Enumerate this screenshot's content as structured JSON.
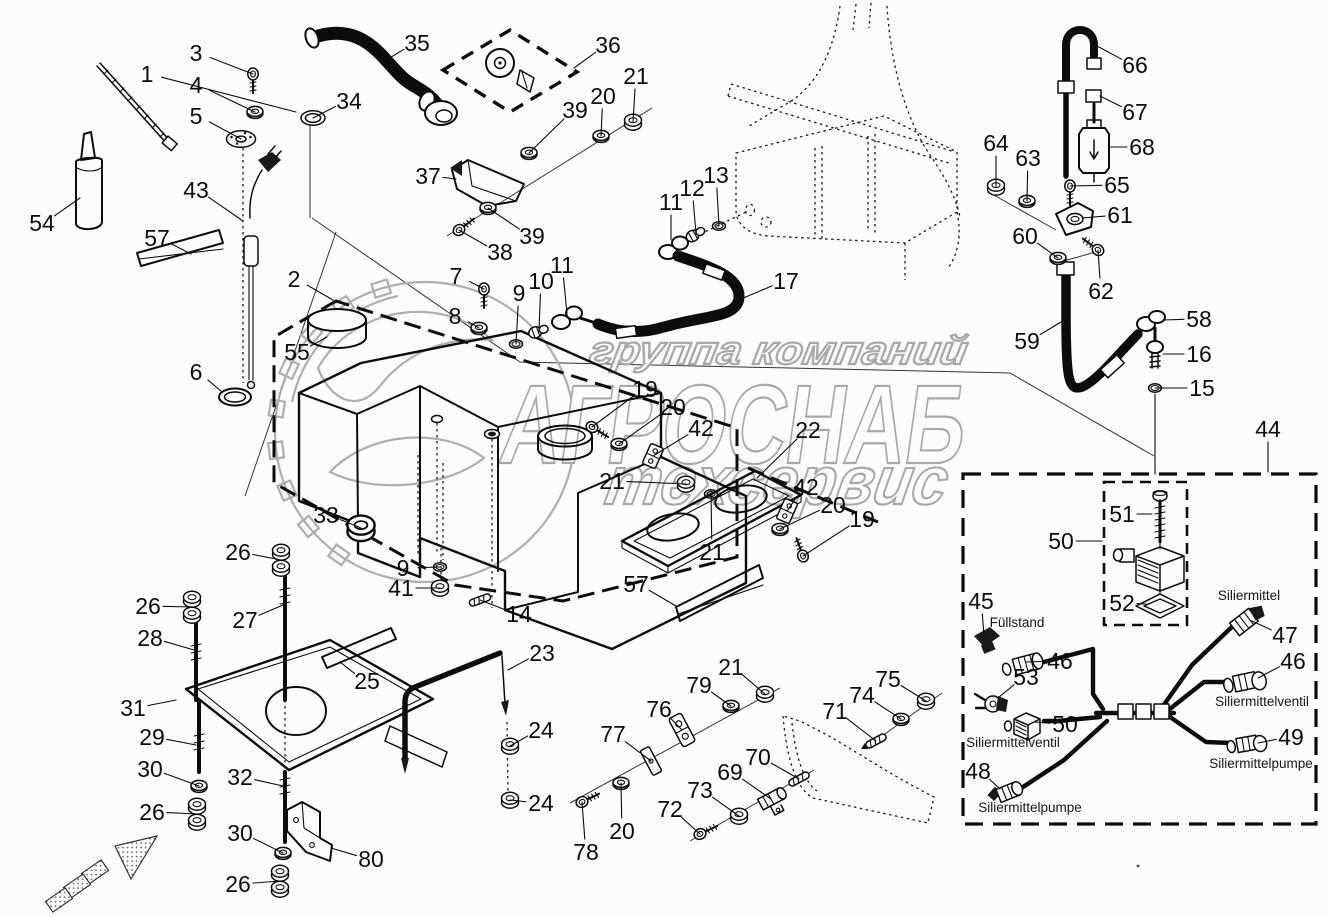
{
  "page": {
    "background": "#fcfcfa",
    "line_color": "#0c0c0c",
    "watermark_color": "#a8a8a8"
  },
  "watermark": {
    "line1": "группа компаний",
    "line2": "АГРОСНАБ",
    "line3": "техсервис",
    "logo": "gear-leaf-emblem"
  },
  "component_labels": [
    {
      "text": "Füllstand",
      "x": 1017,
      "y": 627
    },
    {
      "text": "Siliermittelventil",
      "x": 1013,
      "y": 747
    },
    {
      "text": "Siliermittelpumpe",
      "x": 1030,
      "y": 812
    },
    {
      "text": "Siliermittel",
      "x": 1249,
      "y": 600
    },
    {
      "text": "Siliermittelventil",
      "x": 1262,
      "y": 706
    },
    {
      "text": "Siliermittelpumpe",
      "x": 1261,
      "y": 768
    }
  ],
  "stray_mark": {
    "x": 1138,
    "y": 866
  },
  "callouts": [
    {
      "n": "1",
      "x": 147,
      "y": 74,
      "tx": 296,
      "ty": 112,
      "g": "none"
    },
    {
      "n": "3",
      "x": 196,
      "y": 53,
      "tx": 253,
      "ty": 74,
      "g": "screw",
      "r": 90
    },
    {
      "n": "4",
      "x": 196,
      "y": 85,
      "tx": 255,
      "ty": 112,
      "g": "washer"
    },
    {
      "n": "5",
      "x": 196,
      "y": 116,
      "tx": 241,
      "ty": 139,
      "g": "flange"
    },
    {
      "n": "54",
      "x": 42,
      "y": 223,
      "tx": 80,
      "ty": 198,
      "g": "none"
    },
    {
      "n": "57",
      "x": 157,
      "y": 238,
      "tx": 191,
      "ty": 254,
      "g": "none"
    },
    {
      "n": "43",
      "x": 196,
      "y": 190,
      "tx": 243,
      "ty": 221,
      "g": "none"
    },
    {
      "n": "6",
      "x": 196,
      "y": 372,
      "tx": 222,
      "ty": 392,
      "g": "none"
    },
    {
      "n": "34",
      "x": 349,
      "y": 101,
      "tx": 313,
      "ty": 118,
      "g": "ringbig"
    },
    {
      "n": "35",
      "x": 417,
      "y": 43,
      "tx": 383,
      "ty": 62,
      "g": "none"
    },
    {
      "n": "36",
      "x": 608,
      "y": 45,
      "tx": 574,
      "ty": 68,
      "g": "none"
    },
    {
      "n": "37",
      "x": 428,
      "y": 176,
      "tx": 456,
      "ty": 179,
      "g": "none"
    },
    {
      "n": "38",
      "x": 500,
      "y": 252,
      "tx": 459,
      "ty": 230,
      "g": "screw",
      "r": -37
    },
    {
      "n": "39",
      "x": 532,
      "y": 236,
      "tx": 488,
      "ty": 208,
      "g": "washer"
    },
    {
      "n": "39",
      "x": 575,
      "y": 110,
      "tx": 529,
      "ty": 153,
      "g": "washer"
    },
    {
      "n": "20",
      "x": 603,
      "y": 96,
      "tx": 601,
      "ty": 136,
      "g": "washer"
    },
    {
      "n": "21",
      "x": 636,
      "y": 76,
      "tx": 633,
      "ty": 122,
      "g": "nut"
    },
    {
      "n": "11",
      "x": 671,
      "y": 202,
      "tx": 671,
      "ty": 240,
      "g": "none"
    },
    {
      "n": "12",
      "x": 692,
      "y": 188,
      "tx": 696,
      "ty": 234,
      "g": "plug",
      "r": -30
    },
    {
      "n": "13",
      "x": 716,
      "y": 175,
      "tx": 719,
      "ty": 226,
      "g": "ring"
    },
    {
      "n": "17",
      "x": 786,
      "y": 281,
      "tx": 741,
      "ty": 299,
      "g": "none"
    },
    {
      "n": "2",
      "x": 294,
      "y": 279,
      "tx": 333,
      "ty": 300,
      "g": "none"
    },
    {
      "n": "55",
      "x": 297,
      "y": 352,
      "tx": 327,
      "ty": 337,
      "g": "none"
    },
    {
      "n": "7",
      "x": 456,
      "y": 276,
      "tx": 484,
      "ty": 289,
      "g": "screw",
      "r": 90
    },
    {
      "n": "8",
      "x": 455,
      "y": 316,
      "tx": 479,
      "ty": 328,
      "g": "washer"
    },
    {
      "n": "9",
      "x": 519,
      "y": 293,
      "tx": 516,
      "ty": 344,
      "g": "ring"
    },
    {
      "n": "10",
      "x": 541,
      "y": 281,
      "tx": 539,
      "ty": 331,
      "g": "plug",
      "r": -20
    },
    {
      "n": "11",
      "x": 562,
      "y": 265,
      "tx": 567,
      "ty": 314,
      "g": "none"
    },
    {
      "n": "19",
      "x": 645,
      "y": 389,
      "tx": 592,
      "ty": 427,
      "g": "screw",
      "r": 32
    },
    {
      "n": "20",
      "x": 673,
      "y": 407,
      "tx": 619,
      "ty": 444,
      "g": "washer"
    },
    {
      "n": "42",
      "x": 701,
      "y": 428,
      "tx": 653,
      "ty": 456,
      "g": "plate2",
      "r": 24
    },
    {
      "n": "22",
      "x": 808,
      "y": 430,
      "tx": 757,
      "ty": 478,
      "g": "none"
    },
    {
      "n": "21",
      "x": 612,
      "y": 481,
      "tx": 686,
      "ty": 484,
      "g": "nut"
    },
    {
      "n": "42",
      "x": 806,
      "y": 487,
      "tx": 787,
      "ty": 511,
      "g": "plate2",
      "r": 24
    },
    {
      "n": "20",
      "x": 833,
      "y": 505,
      "tx": 780,
      "ty": 529,
      "g": "washer"
    },
    {
      "n": "19",
      "x": 862,
      "y": 519,
      "tx": 803,
      "ty": 556,
      "g": "screw",
      "r": -110
    },
    {
      "n": "21",
      "x": 712,
      "y": 552,
      "tx": 711,
      "ty": 494,
      "g": "ring"
    },
    {
      "n": "33",
      "x": 326,
      "y": 515,
      "tx": 361,
      "ty": 528,
      "g": "nutbig"
    },
    {
      "n": "9",
      "x": 403,
      "y": 568,
      "tx": 440,
      "ty": 567,
      "g": "ring"
    },
    {
      "n": "41",
      "x": 401,
      "y": 588,
      "tx": 440,
      "ty": 588,
      "g": "nut"
    },
    {
      "n": "14",
      "x": 519,
      "y": 614,
      "tx": 480,
      "ty": 600,
      "g": "pin",
      "r": -20
    },
    {
      "n": "57",
      "x": 636,
      "y": 584,
      "tx": 676,
      "ty": 606,
      "g": "none"
    },
    {
      "n": "26",
      "x": 238,
      "y": 552,
      "tx": 281,
      "ty": 560,
      "g": "nut2"
    },
    {
      "n": "27",
      "x": 245,
      "y": 620,
      "tx": 283,
      "ty": 605,
      "g": "none"
    },
    {
      "n": "26",
      "x": 148,
      "y": 606,
      "tx": 192,
      "ty": 607,
      "g": "nut2"
    },
    {
      "n": "28",
      "x": 150,
      "y": 638,
      "tx": 194,
      "ty": 650,
      "g": "none"
    },
    {
      "n": "31",
      "x": 133,
      "y": 708,
      "tx": 176,
      "ty": 700,
      "g": "none"
    },
    {
      "n": "29",
      "x": 152,
      "y": 737,
      "tx": 196,
      "ty": 745,
      "g": "none"
    },
    {
      "n": "30",
      "x": 150,
      "y": 769,
      "tx": 199,
      "ty": 786,
      "g": "washer"
    },
    {
      "n": "26",
      "x": 152,
      "y": 812,
      "tx": 197,
      "ty": 814,
      "g": "nut2"
    },
    {
      "n": "32",
      "x": 240,
      "y": 777,
      "tx": 283,
      "ty": 786,
      "g": "none"
    },
    {
      "n": "30",
      "x": 240,
      "y": 833,
      "tx": 283,
      "ty": 853,
      "g": "washer"
    },
    {
      "n": "26",
      "x": 238,
      "y": 884,
      "tx": 280,
      "ty": 881,
      "g": "nut2"
    },
    {
      "n": "80",
      "x": 371,
      "y": 859,
      "tx": 331,
      "ty": 848,
      "g": "none"
    },
    {
      "n": "25",
      "x": 367,
      "y": 681,
      "tx": 340,
      "ty": 662,
      "g": "none"
    },
    {
      "n": "23",
      "x": 542,
      "y": 653,
      "tx": 508,
      "ty": 670,
      "g": "none"
    },
    {
      "n": "24",
      "x": 541,
      "y": 730,
      "tx": 510,
      "ty": 746,
      "g": "nut"
    },
    {
      "n": "24",
      "x": 541,
      "y": 803,
      "tx": 510,
      "ty": 800,
      "g": "nut"
    },
    {
      "n": "79",
      "x": 699,
      "y": 685,
      "tx": 731,
      "ty": 706,
      "g": "washer"
    },
    {
      "n": "21",
      "x": 731,
      "y": 667,
      "tx": 765,
      "ty": 694,
      "g": "nut"
    },
    {
      "n": "76",
      "x": 659,
      "y": 709,
      "tx": 682,
      "ty": 730,
      "g": "none"
    },
    {
      "n": "77",
      "x": 613,
      "y": 734,
      "tx": 651,
      "ty": 761,
      "g": "none"
    },
    {
      "n": "78",
      "x": 586,
      "y": 852,
      "tx": 582,
      "ty": 802,
      "g": "screw",
      "r": -26
    },
    {
      "n": "20",
      "x": 622,
      "y": 831,
      "tx": 621,
      "ty": 783,
      "g": "washer"
    },
    {
      "n": "72",
      "x": 670,
      "y": 809,
      "tx": 700,
      "ty": 834,
      "g": "screw",
      "r": -25
    },
    {
      "n": "73",
      "x": 700,
      "y": 790,
      "tx": 739,
      "ty": 816,
      "g": "nut"
    },
    {
      "n": "69",
      "x": 730,
      "y": 772,
      "tx": 771,
      "ty": 799,
      "g": "none"
    },
    {
      "n": "70",
      "x": 758,
      "y": 757,
      "tx": 799,
      "ty": 779,
      "g": "pin",
      "r": -28
    },
    {
      "n": "71",
      "x": 835,
      "y": 711,
      "tx": 876,
      "ty": 741,
      "g": "pinarrow",
      "r": -28
    },
    {
      "n": "74",
      "x": 862,
      "y": 695,
      "tx": 901,
      "ty": 719,
      "g": "washer"
    },
    {
      "n": "75",
      "x": 888,
      "y": 679,
      "tx": 926,
      "ty": 701,
      "g": "nut"
    },
    {
      "n": "66",
      "x": 1135,
      "y": 65,
      "tx": 1097,
      "ty": 46,
      "g": "none"
    },
    {
      "n": "67",
      "x": 1135,
      "y": 112,
      "tx": 1100,
      "ty": 96,
      "g": "none"
    },
    {
      "n": "68",
      "x": 1142,
      "y": 147,
      "tx": 1110,
      "ty": 147,
      "g": "none"
    },
    {
      "n": "65",
      "x": 1117,
      "y": 185,
      "tx": 1070,
      "ty": 186,
      "g": "screw",
      "r": 90
    },
    {
      "n": "64",
      "x": 996,
      "y": 143,
      "tx": 996,
      "ty": 187,
      "g": "nut"
    },
    {
      "n": "63",
      "x": 1028,
      "y": 158,
      "tx": 1027,
      "ty": 201,
      "g": "washer"
    },
    {
      "n": "61",
      "x": 1120,
      "y": 215,
      "tx": 1082,
      "ty": 218,
      "g": "none"
    },
    {
      "n": "60",
      "x": 1025,
      "y": 236,
      "tx": 1058,
      "ty": 258,
      "g": "washer"
    },
    {
      "n": "62",
      "x": 1101,
      "y": 291,
      "tx": 1098,
      "ty": 250,
      "g": "screw",
      "r": -143
    },
    {
      "n": "59",
      "x": 1027,
      "y": 341,
      "tx": 1066,
      "ty": 319,
      "g": "none"
    },
    {
      "n": "58",
      "x": 1199,
      "y": 319,
      "tx": 1163,
      "ty": 320,
      "g": "none"
    },
    {
      "n": "16",
      "x": 1199,
      "y": 354,
      "tx": 1163,
      "ty": 354,
      "g": "none"
    },
    {
      "n": "15",
      "x": 1202,
      "y": 388,
      "tx": 1155,
      "ty": 388,
      "g": "ring"
    },
    {
      "n": "44",
      "x": 1268,
      "y": 429,
      "tx": 1268,
      "ty": 472,
      "g": "none"
    },
    {
      "n": "50",
      "x": 1061,
      "y": 541,
      "tx": 1102,
      "ty": 541,
      "g": "none"
    },
    {
      "n": "51",
      "x": 1122,
      "y": 514,
      "tx": 1152,
      "ty": 514,
      "g": "none"
    },
    {
      "n": "52",
      "x": 1122,
      "y": 603,
      "tx": 1146,
      "ty": 604,
      "g": "none"
    },
    {
      "n": "45",
      "x": 981,
      "y": 601,
      "tx": 984,
      "ty": 636,
      "g": "none"
    },
    {
      "n": "46",
      "x": 1060,
      "y": 661,
      "tx": 1026,
      "ty": 662,
      "g": "none"
    },
    {
      "n": "53",
      "x": 1026,
      "y": 677,
      "tx": 998,
      "ty": 698,
      "g": "none"
    },
    {
      "n": "50",
      "x": 1065,
      "y": 724,
      "tx": 1034,
      "ty": 722,
      "g": "none"
    },
    {
      "n": "48",
      "x": 978,
      "y": 771,
      "tx": 1000,
      "ty": 789,
      "g": "none"
    },
    {
      "n": "47",
      "x": 1285,
      "y": 635,
      "tx": 1252,
      "ty": 621,
      "g": "none"
    },
    {
      "n": "46",
      "x": 1293,
      "y": 661,
      "tx": 1258,
      "ty": 678,
      "g": "none"
    },
    {
      "n": "49",
      "x": 1291,
      "y": 737,
      "tx": 1258,
      "ty": 743,
      "g": "none"
    }
  ]
}
